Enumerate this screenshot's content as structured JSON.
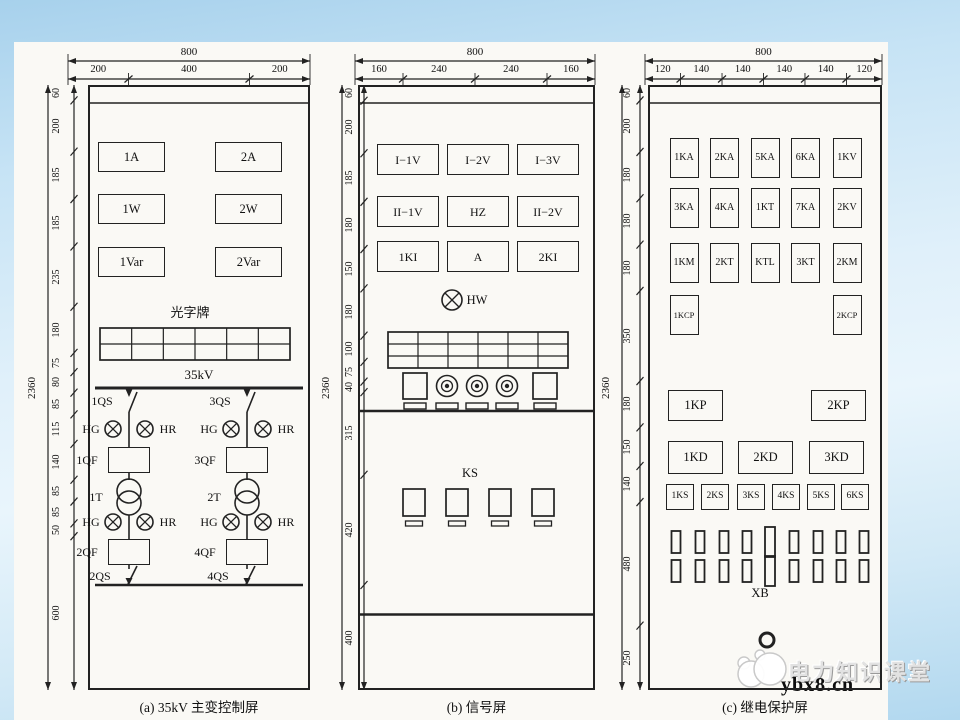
{
  "colors": {
    "line": "#222222",
    "paper": "#faf9f5",
    "bg_top": "#a7d1ec",
    "bg_bottom": "#b2d8ef"
  },
  "watermark": {
    "brand": "电力知识课堂",
    "site": "ybx8.cn",
    "logo": "mascot-logo"
  },
  "panels": [
    {
      "id": "a",
      "caption": "(a) 35kV 主变控制屏",
      "top_dims": {
        "total": "800",
        "segments": [
          "200",
          "400",
          "200"
        ]
      },
      "left_dims": {
        "total": "2360",
        "segments": [
          "60",
          "200",
          "185",
          "185",
          "235",
          "180",
          "75",
          "80",
          "85",
          "115",
          "140",
          "85",
          "85",
          "50",
          "600"
        ]
      },
      "meter_rows": [
        [
          "1A",
          "2A"
        ],
        [
          "1W",
          "2W"
        ],
        [
          "1Var",
          "2Var"
        ]
      ],
      "light_plate_label": "光字牌",
      "light_plate": {
        "cols": 6,
        "rows": 2
      },
      "bus_label": "35kV",
      "branches": [
        {
          "qs_top": "1QS",
          "lamps_top": [
            "HG",
            "HR"
          ],
          "qf_top": "1QF",
          "transformer": "1T",
          "lamps_bottom": [
            "HG",
            "HR"
          ],
          "qf_bottom": "2QF",
          "qs_bottom": "2QS"
        },
        {
          "qs_top": "3QS",
          "lamps_top": [
            "HG",
            "HR"
          ],
          "qf_top": "3QF",
          "transformer": "2T",
          "lamps_bottom": [
            "HG",
            "HR"
          ],
          "qf_bottom": "4QF",
          "qs_bottom": "4QS"
        }
      ]
    },
    {
      "id": "b",
      "caption": "(b) 信号屏",
      "top_dims": {
        "total": "800",
        "segments": [
          "160",
          "240",
          "240",
          "160"
        ]
      },
      "left_dims": {
        "total": "2360",
        "segments": [
          "60",
          "200",
          "185",
          "180",
          "150",
          "180",
          "100",
          "75",
          "40",
          "315",
          "420",
          "400"
        ]
      },
      "meter_rows": [
        [
          "I−1V",
          "I−2V",
          "I−3V"
        ],
        [
          "II−1V",
          "HZ",
          "II−2V"
        ],
        [
          "1KI",
          "A",
          "2KI"
        ]
      ],
      "hw_lamp_label": "HW",
      "light_plate": {
        "cols": 6,
        "rows": 3
      },
      "control_row": {
        "switch_count": 2,
        "button_count": 3
      },
      "ks_label": "KS",
      "ks_count": 4
    },
    {
      "id": "c",
      "caption": "(c) 继电保护屏",
      "top_dims": {
        "total": "800",
        "segments": [
          "120",
          "140",
          "140",
          "140",
          "140",
          "120"
        ]
      },
      "left_dims": {
        "total": "2360",
        "segments": [
          "60",
          "200",
          "180",
          "180",
          "180",
          "350",
          "180",
          "150",
          "140",
          "480",
          "250"
        ]
      },
      "relay_rows": [
        [
          "1KA",
          "2KA",
          "5KA",
          "6KA",
          "1KV"
        ],
        [
          "3KA",
          "4KA",
          "1KT",
          "7KA",
          "2KV"
        ],
        [
          "1KM",
          "2KT",
          "KTL",
          "3KT",
          "2KM"
        ]
      ],
      "kcp_row": [
        "1KCP",
        "2KCP"
      ],
      "kp_row": [
        "1KP",
        "2KP"
      ],
      "kd_row": [
        "1KD",
        "2KD",
        "3KD"
      ],
      "ks_row": [
        "1KS",
        "2KS",
        "3KS",
        "4KS",
        "5KS",
        "6KS"
      ],
      "terminal_rows": 2,
      "terminals_per_row": 9,
      "xb_label": "XB"
    }
  ]
}
